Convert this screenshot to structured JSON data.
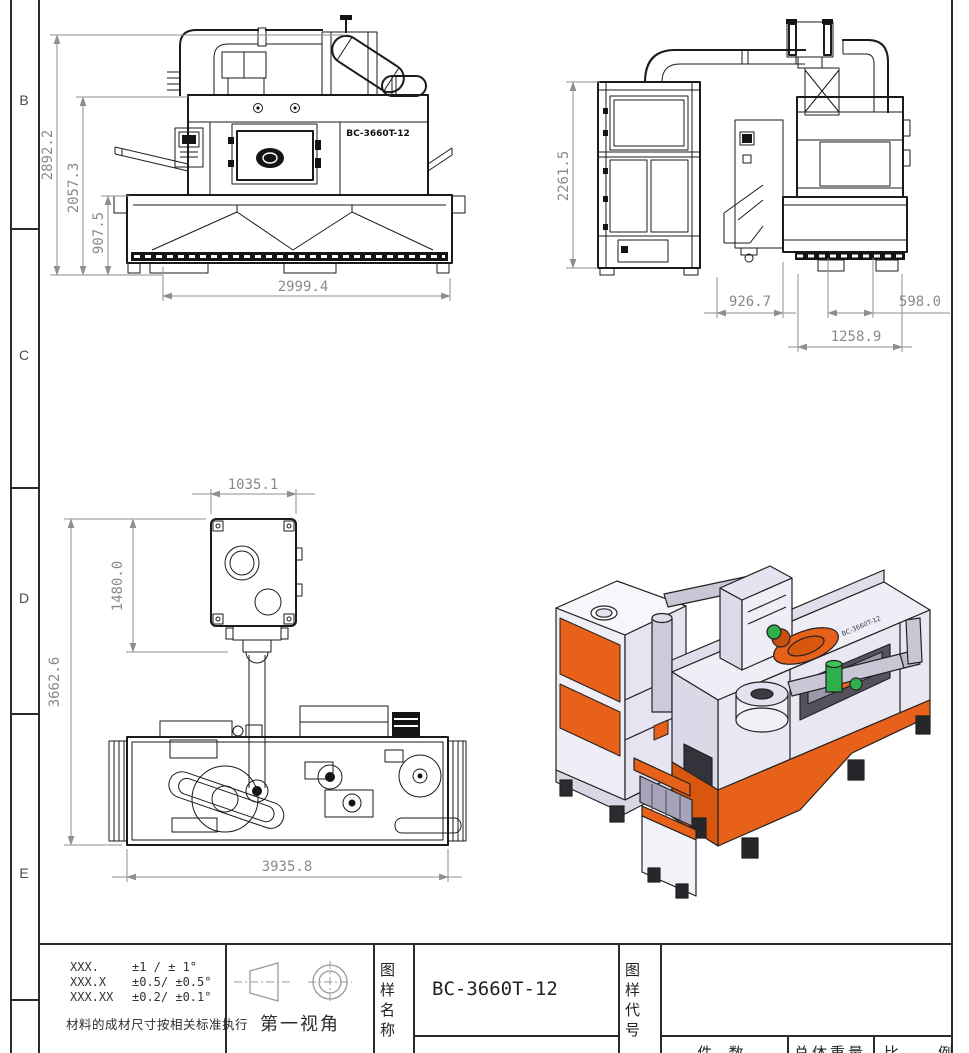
{
  "sheet": {
    "zones": [
      "B",
      "C",
      "D",
      "E"
    ]
  },
  "colors": {
    "outline": "#1b1b1b",
    "dim_gray": "#8a8a8a",
    "orange": "#E8611A",
    "orange_dark": "#D9560F",
    "body_light": "#EFEDF6",
    "body_mid": "#E0DDEA",
    "pipe_gray": "#C9C7D6",
    "green": "#2FAF4C"
  },
  "views": {
    "front": {
      "nameplate": "BC-3660T-12",
      "dims": {
        "total_height": "2892.2",
        "body_height": "2057.3",
        "hopper_height": "907.5",
        "base_width": "2999.4"
      }
    },
    "side": {
      "dims": {
        "collector_height": "2261.5",
        "gap_width": "926.7",
        "outlet_width": "598.0",
        "machine_width": "1258.9"
      }
    },
    "plan": {
      "dims": {
        "collector_width": "1035.1",
        "collector_depth": "1480.0",
        "total_depth": "3662.6",
        "total_width": "3935.8"
      }
    },
    "iso": {
      "nameplate": "BC-3660T-12"
    }
  },
  "title_block": {
    "tolerance_rows": [
      {
        "digits": "XXX.",
        "tol": "±1  / ± 1°"
      },
      {
        "digits": "XXX.X",
        "tol": "±0.5/ ±0.5°"
      },
      {
        "digits": "XXX.XX",
        "tol": "±0.2/ ±0.1°"
      }
    ],
    "material_note": "材料的成材尺寸按相关标准执行",
    "projection_label": "第一视角",
    "name_label": "图样名称",
    "name_value": "BC-3660T-12",
    "code_label": "图样代号",
    "code_value": "",
    "bottom_row": {
      "qty_label": "件 数",
      "weight_label": "总体重量",
      "scale_label_a": "比",
      "scale_label_b": "例"
    }
  }
}
